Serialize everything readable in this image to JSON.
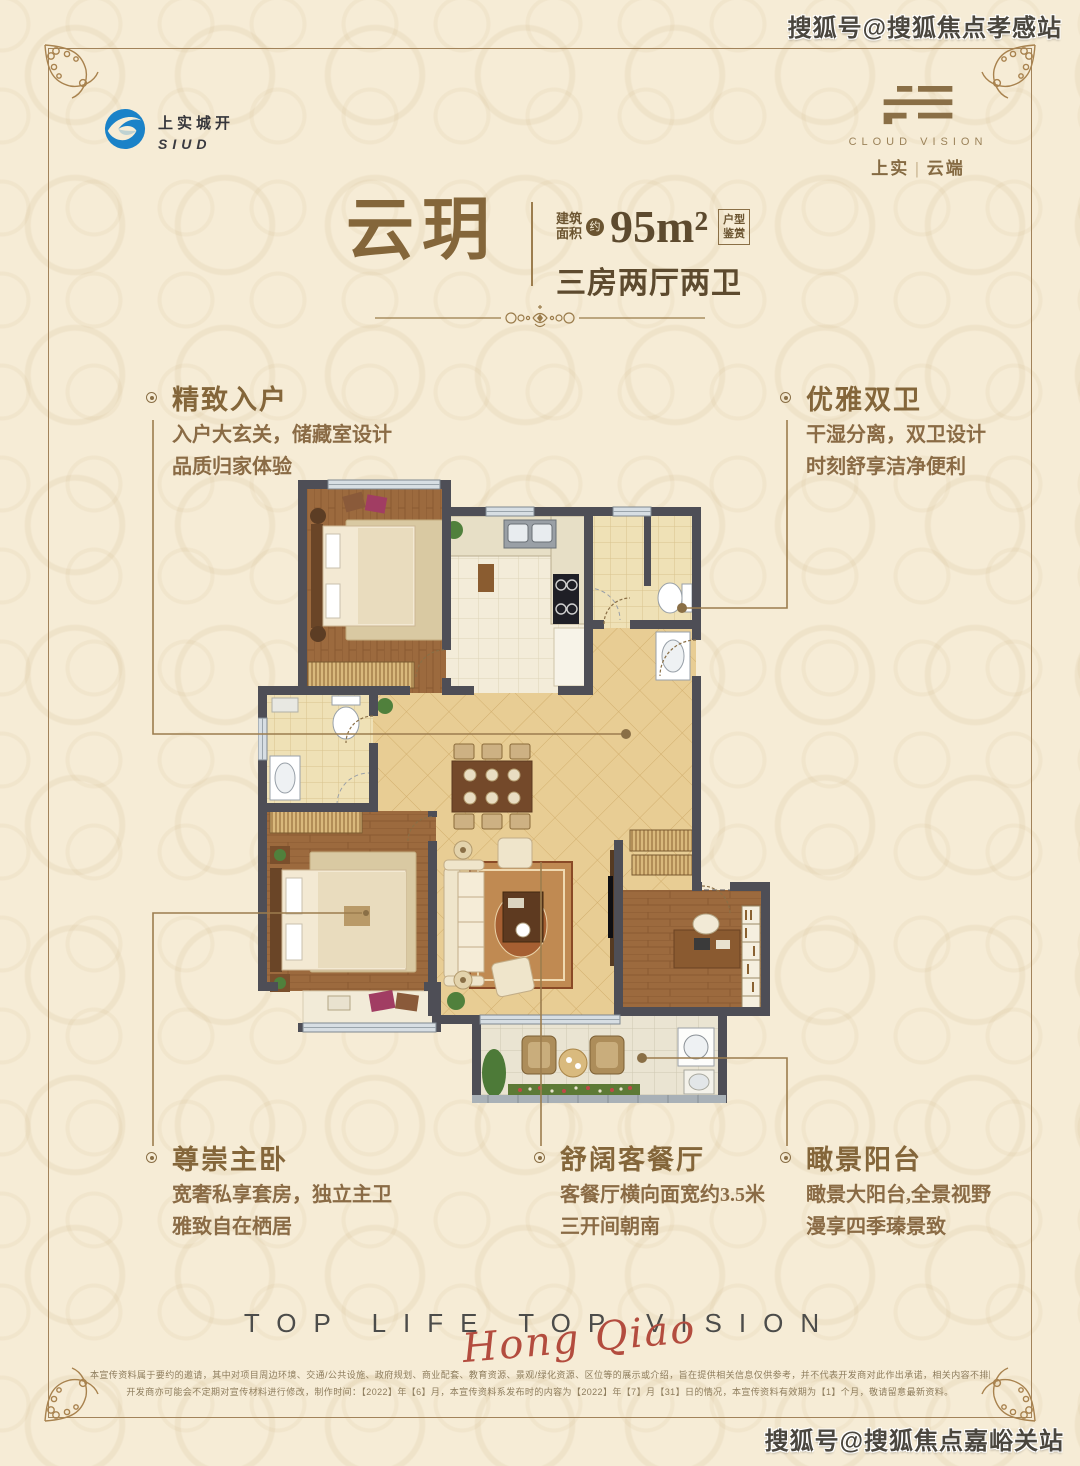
{
  "watermarks": {
    "top_right": "搜狐号@搜狐焦点孝感站",
    "bottom_right": "搜狐号@搜狐焦点嘉峪关站"
  },
  "developer_logo": {
    "cn": "上实城开",
    "en": "SIUD"
  },
  "project_logo": {
    "en": "CLOUD VISION",
    "cn_left": "上实",
    "cn_right": "云端"
  },
  "title": {
    "name": "云玥",
    "area_label_top": "建筑",
    "area_label_bottom": "面积",
    "area_approx": "约",
    "area_value": "95m²",
    "badge_top": "户型",
    "badge_bottom": "鉴赏",
    "layout": "三房两厅两卫"
  },
  "features": [
    {
      "title": "精致入户",
      "line1": "入户大玄关，储藏室设计",
      "line2": "品质归家体验"
    },
    {
      "title": "优雅双卫",
      "line1": "干湿分离，双卫设计",
      "line2": "时刻舒享洁净便利"
    },
    {
      "title": "尊崇主卧",
      "line1": "宽奢私享套房，独立主卫",
      "line2": "雅致自在栖居"
    },
    {
      "title": "舒阔客餐厅",
      "line1": "客餐厅横向面宽约3.5米",
      "line2": "三开间朝南"
    },
    {
      "title": "瞰景阳台",
      "line1": "瞰景大阳台,全景视野",
      "line2": "漫享四季瑧景致"
    }
  ],
  "footer": {
    "slogan": "TOP LIFE TOP VISION",
    "script": "Hong Qiao",
    "disclaimer_line1": "本宣传资料属于要约的邀请，其中对项目周边环境、交通/公共设施、政府规划、商业配套、教育资源、景观/绿化资源、区位等的展示或介绍，旨在提供相关信息仅供参考，并不代表开发商对此作出承诺，相关内容不排除因政府相关规划、规定及开发商未能控制的原因而发生变化。",
    "disclaimer_line2": "开发商亦可能会不定期对宣传材料进行修改，制作时间：【2022】年【6】月，本宣传资料系发布时的内容为【2022】年【7】月【31】日的情况，本宣传资料有效期为【1】个月，敬请留意最新资料。"
  },
  "colors": {
    "background": "#f6ecd6",
    "accent_gold": "#8a6f46",
    "title_brown": "#84663a",
    "script_red": "#b34c3e",
    "logo_blue": "#1a82c8",
    "wall_gray": "#4e4e56",
    "living_floor": "#e8cd94",
    "wood_floor": "#9c6a3e"
  }
}
